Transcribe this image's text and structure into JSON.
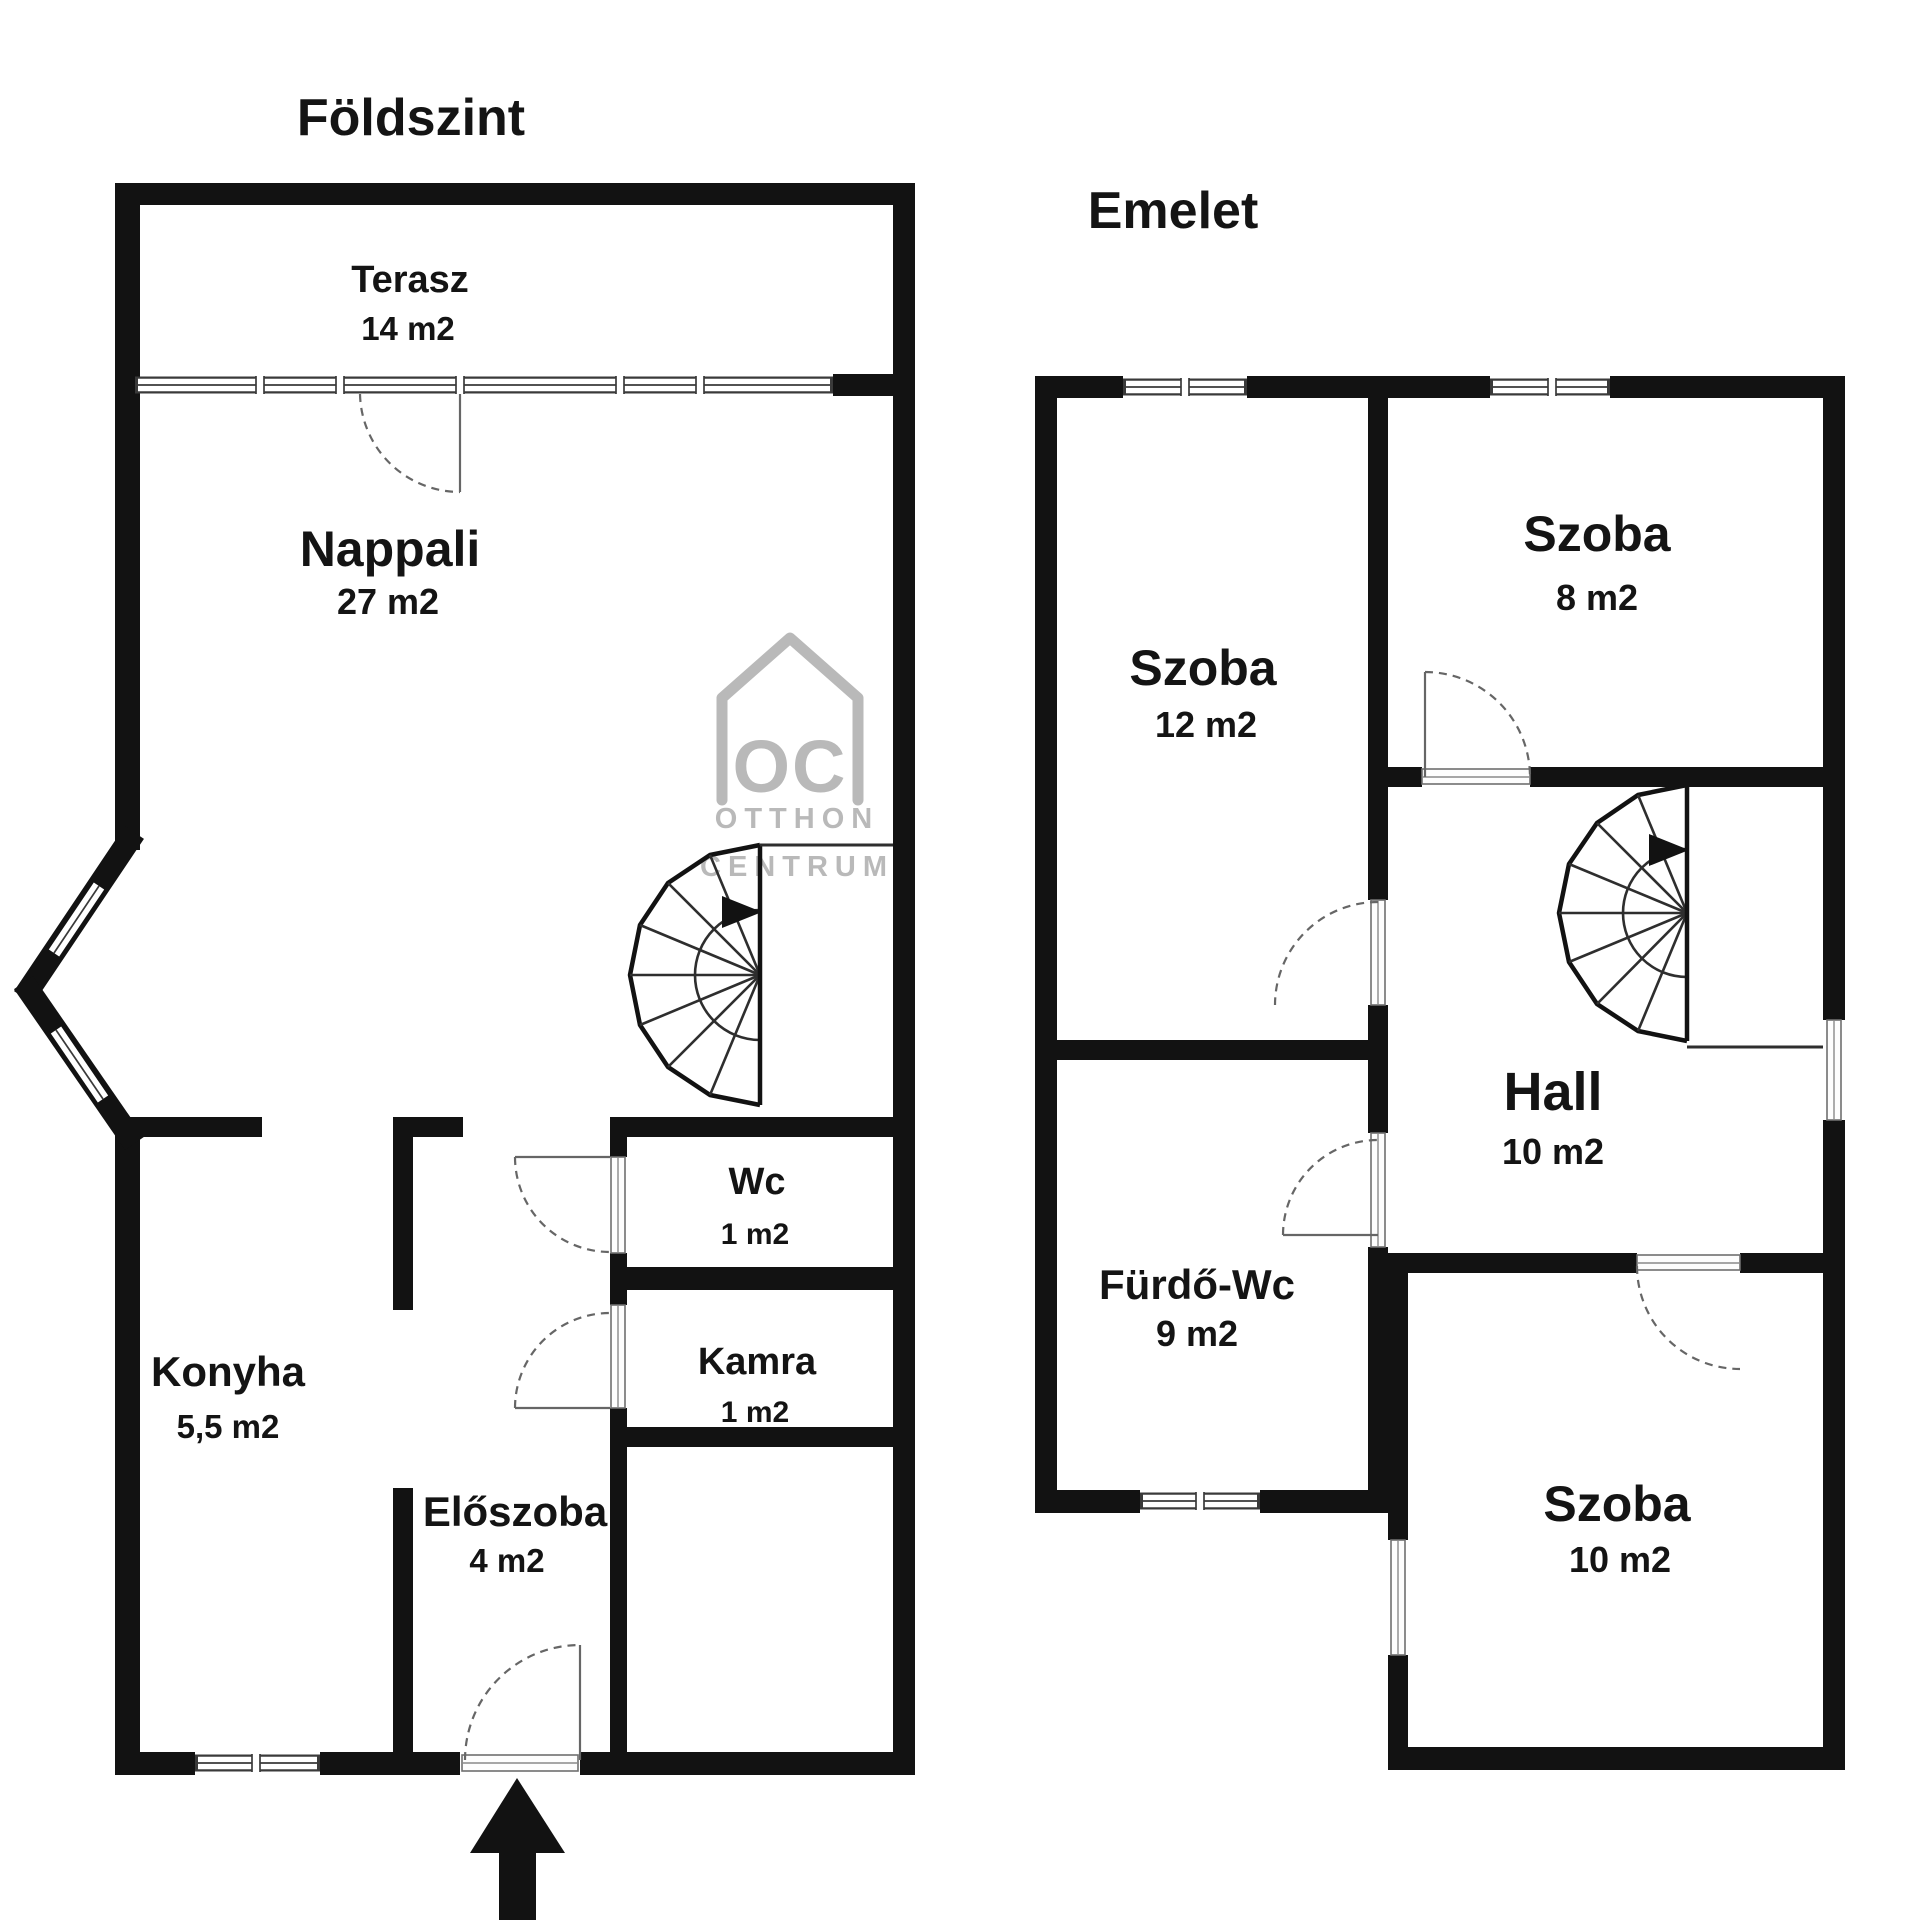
{
  "ground": {
    "title": "Földszint",
    "rooms": [
      {
        "id": "terasz",
        "name": "Terasz",
        "area": "14 m2"
      },
      {
        "id": "nappali",
        "name": "Nappali",
        "area": "27 m2"
      },
      {
        "id": "wc",
        "name": "Wc",
        "area": "1 m2"
      },
      {
        "id": "kamra",
        "name": "Kamra",
        "area": "1 m2"
      },
      {
        "id": "konyha",
        "name": "Konyha",
        "area": "5,5 m2"
      },
      {
        "id": "eloszoba",
        "name": "Előszoba",
        "area": "4 m2"
      }
    ]
  },
  "upper": {
    "title": "Emelet",
    "rooms": [
      {
        "id": "szoba12",
        "name": "Szoba",
        "area": "12 m2"
      },
      {
        "id": "szoba8",
        "name": "Szoba",
        "area": "8 m2"
      },
      {
        "id": "hall",
        "name": "Hall",
        "area": "10 m2"
      },
      {
        "id": "furdo_wc",
        "name": "Fürdő-Wc",
        "area": "9 m2"
      },
      {
        "id": "szoba10",
        "name": "Szoba",
        "area": "10 m2"
      }
    ]
  },
  "watermark": {
    "logo_text": "OC",
    "line1": "OTTHON",
    "line2": "CENTRUM"
  },
  "colors": {
    "wall": "#121212",
    "door": "#666666",
    "watermark": "#b9b9b9",
    "background": "#ffffff"
  }
}
